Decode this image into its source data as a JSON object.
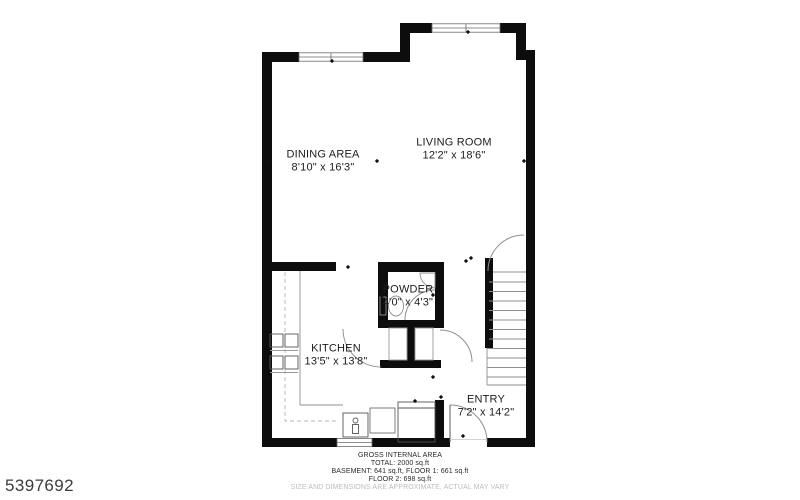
{
  "watermark": "5397692",
  "rooms": {
    "dining": {
      "name": "DINING AREA",
      "dims": "8'10\" x 16'3\""
    },
    "living": {
      "name": "LIVING ROOM",
      "dims": "12'2\" x 18'6\""
    },
    "powder": {
      "name": "POWDER",
      "dims": "4'0\" x 4'3\""
    },
    "kitchen": {
      "name": "KITCHEN",
      "dims": "13'5\" x 13'8\""
    },
    "entry": {
      "name": "ENTRY",
      "dims": "7'2\" x 14'2\""
    }
  },
  "footer": {
    "title": "GROSS INTERNAL AREA",
    "total": "TOTAL: 2000 sq.ft",
    "areas_line1": "BASEMENT: 641 sq.ft, FLOOR 1: 661 sq.ft",
    "areas_line2": "FLOOR 2: 698 sq.ft",
    "disclaimer": "SIZE AND DIMENSIONS ARE APPROXIMATE, ACTUAL MAY VARY"
  },
  "colors": {
    "wall": "#0d0d0d",
    "line": "#8f8f8f",
    "text": "#1c1c1c",
    "muted": "#bcbcbc"
  }
}
